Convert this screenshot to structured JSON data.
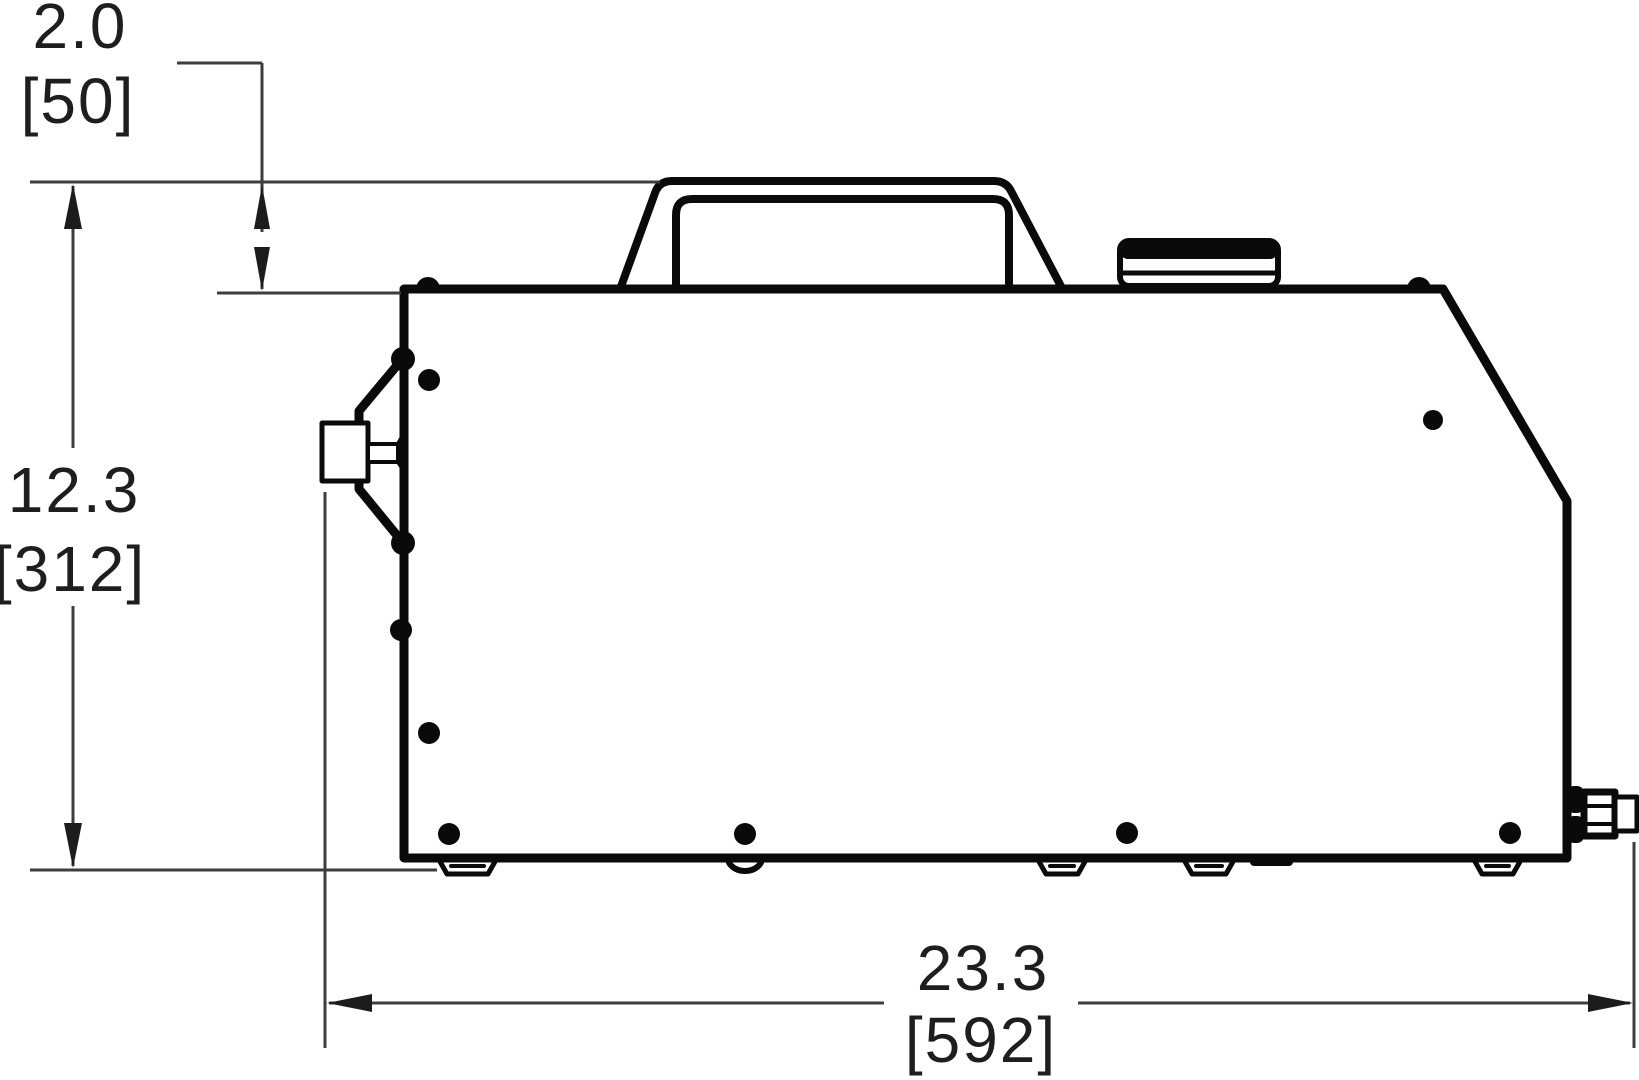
{
  "drawing": {
    "kind": "technical-drawing-side-view",
    "colors": {
      "outline": "#0a0a0a",
      "dimension": "#3d3d3d",
      "background": "#ffffff"
    },
    "dimensions": {
      "handle_height": {
        "in": "2.0",
        "mm": "[50]"
      },
      "overall_height": {
        "in": "12.3",
        "mm": "[312]"
      },
      "overall_width": {
        "in": "23.3",
        "mm": "[592]"
      }
    }
  }
}
